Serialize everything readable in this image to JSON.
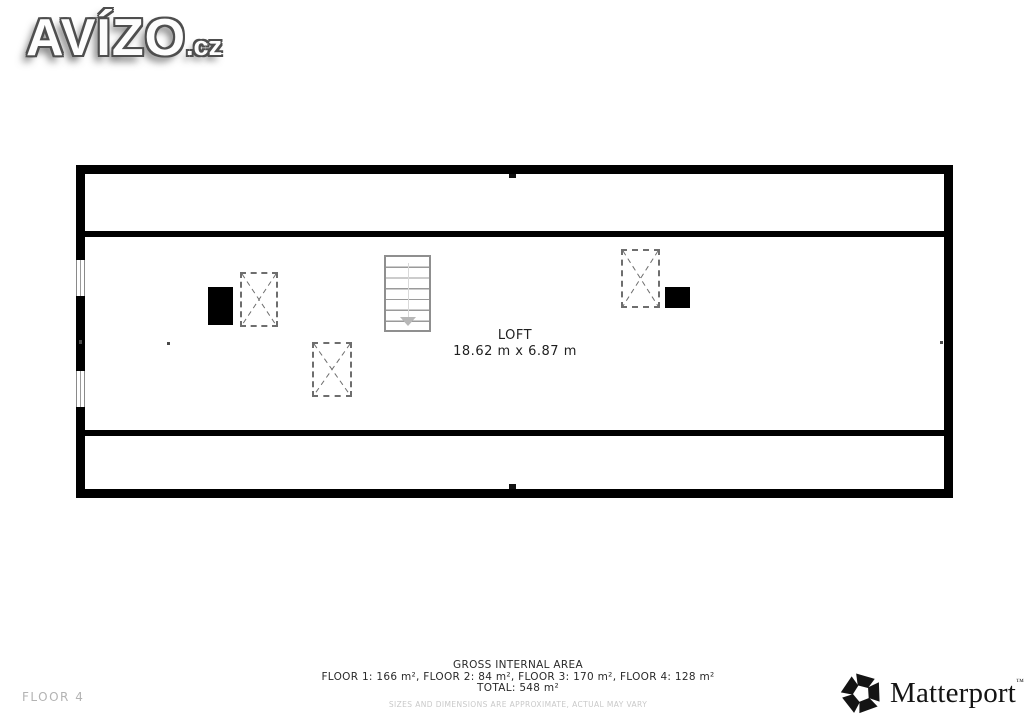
{
  "watermark": {
    "brand": "AVÍZO",
    "tld": ".cz"
  },
  "plan": {
    "room_label": "LOFT",
    "room_dimensions": "18.62 m x 6.87 m"
  },
  "footer": {
    "floor_indicator": "FLOOR 4",
    "area_title": "GROSS INTERNAL AREA",
    "area_breakdown": "FLOOR 1: 166 m², FLOOR 2: 84 m², FLOOR 3: 170 m², FLOOR 4: 128 m²",
    "area_total": "TOTAL: 548 m²",
    "disclaimer": "SIZES AND DIMENSIONS ARE APPROXIMATE, ACTUAL MAY VARY",
    "brand": "Matterport",
    "brand_trademark": "™"
  },
  "colors": {
    "wall": "#000000",
    "background": "#ffffff",
    "stairs_outline": "#8f8f8f",
    "dashed_feature": "#6e6e6e",
    "muted_text": "#b3b3b3",
    "disclaimer_text": "#c9c9c9",
    "body_text": "#2a2a2a"
  }
}
